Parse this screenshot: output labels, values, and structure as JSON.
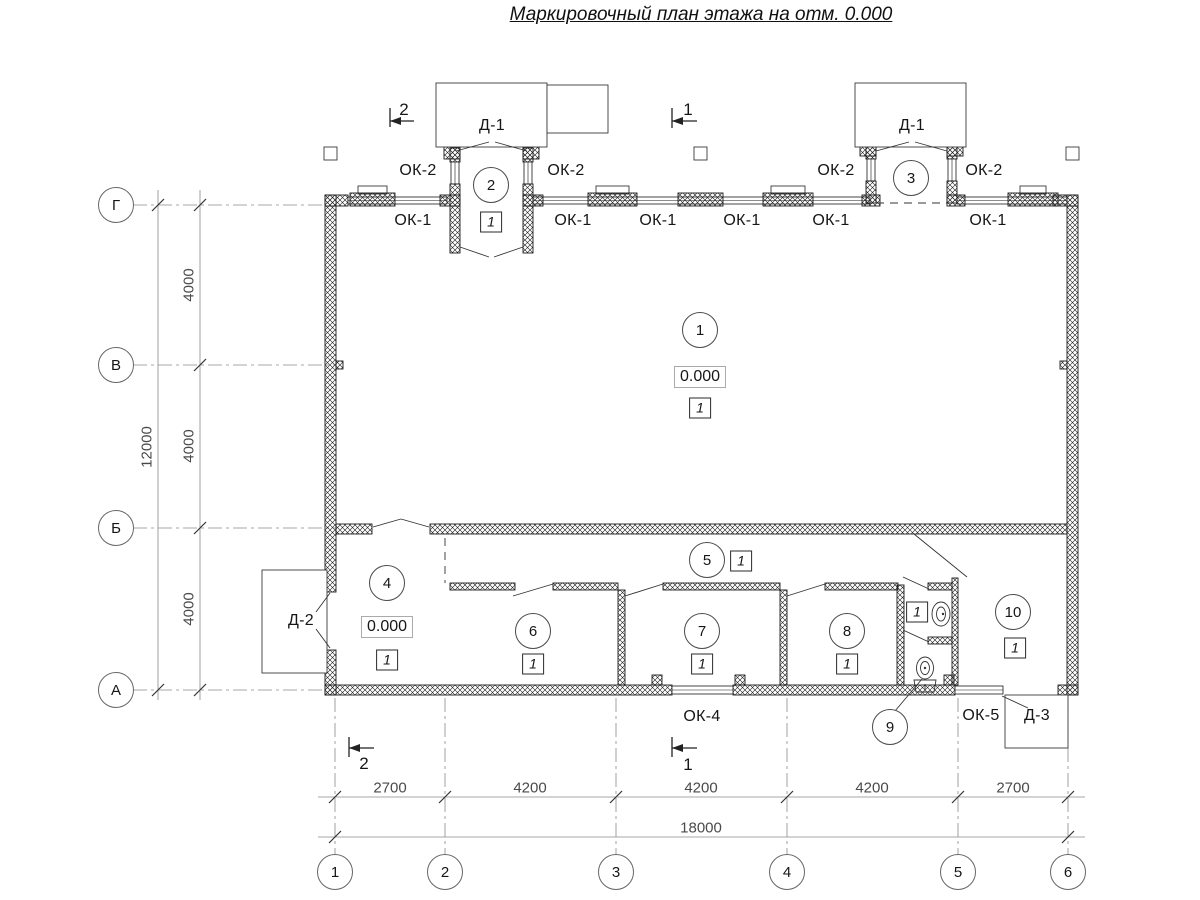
{
  "title": "Маркировочный план этажа на отм. 0.000",
  "axes": {
    "rows": [
      "Г",
      "В",
      "Б",
      "А"
    ],
    "cols": [
      "1",
      "2",
      "3",
      "4",
      "5",
      "6"
    ]
  },
  "dimensions": {
    "vertical_segments": [
      "4000",
      "4000",
      "4000"
    ],
    "vertical_total": "12000",
    "horizontal_segments": [
      "2700",
      "4200",
      "4200",
      "4200",
      "2700"
    ],
    "horizontal_total": "18000"
  },
  "section_marks": {
    "top_left": "2",
    "top_center": "1",
    "bottom_left": "2",
    "bottom_center": "1"
  },
  "room_numbers": [
    "1",
    "2",
    "3",
    "4",
    "5",
    "6",
    "7",
    "8",
    "9",
    "10"
  ],
  "floor_type_mark": "1",
  "elevation_mark": "0.000",
  "door_marks": {
    "d1": "Д-1",
    "d2": "Д-2",
    "d3": "Д-3"
  },
  "window_marks": {
    "ok1": "ОК-1",
    "ok2": "ОК-2",
    "ok4": "ОК-4",
    "ok5": "ОК-5"
  }
}
